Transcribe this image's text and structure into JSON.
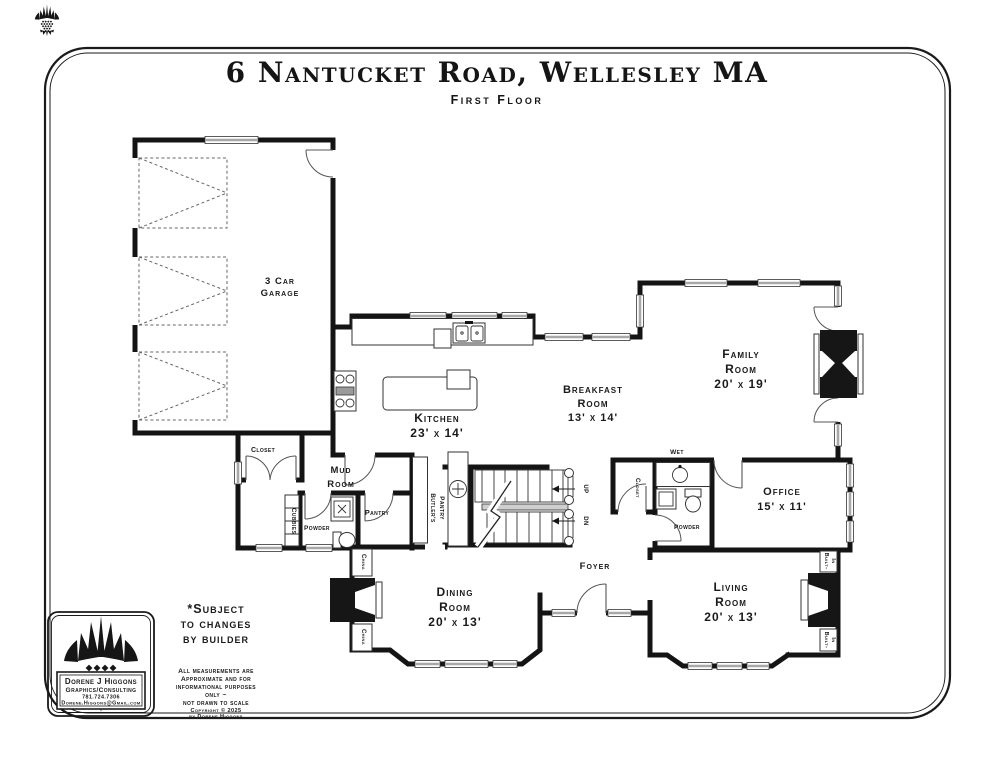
{
  "page": {
    "title": "6 Nantucket Road, Wellesley MA",
    "subtitle": "First Floor"
  },
  "rooms": {
    "garage": {
      "lines": [
        "3 Car",
        "Garage"
      ]
    },
    "closet_mud": {
      "label": "Closet"
    },
    "mud": {
      "lines": [
        "Mud",
        "Room"
      ]
    },
    "cubbies": {
      "label": "Cubbies"
    },
    "powder_mud": {
      "label": "Powder"
    },
    "pantry": {
      "label": "Pantry"
    },
    "butlers_pantry": {
      "lines": [
        "Butler's",
        "Pantry"
      ]
    },
    "kitchen": {
      "lines": [
        "Kitchen",
        "23' x 14'"
      ]
    },
    "breakfast": {
      "lines": [
        "Breakfast",
        "Room",
        "13' x 14'"
      ]
    },
    "family": {
      "lines": [
        "Family",
        "Room",
        "20' x 19'"
      ]
    },
    "wet_bar": {
      "lines": [
        "Wet",
        "Bar"
      ]
    },
    "closet_foyer": {
      "label": "Closet"
    },
    "powder_foyer": {
      "label": "Powder"
    },
    "office": {
      "lines": [
        "Office",
        "15' x 11'"
      ]
    },
    "foyer": {
      "label": "Foyer"
    },
    "dining": {
      "lines": [
        "Dining",
        "Room",
        "20' x 13'"
      ]
    },
    "china": {
      "label": "China"
    },
    "living": {
      "lines": [
        "Living",
        "Room",
        "20' x 13'"
      ]
    },
    "built_in": {
      "lines": [
        "Built-",
        "In"
      ]
    },
    "stairs": {
      "up": "UP",
      "down": "DN"
    }
  },
  "notes": {
    "subject": [
      "*Subject",
      "to changes",
      "by builder"
    ],
    "disclaimer": [
      "All measurements are",
      "Approximate and for",
      "informational purposes",
      "only ~",
      "not drawn to scale"
    ],
    "copyright": [
      "Copyright © 2025",
      "by Dorene Higgons"
    ]
  },
  "logo": {
    "name": "Dorene J Higgons",
    "tagline": "Graphics/Consulting",
    "phone": "781.724.7306",
    "email": "Dorene.Higgons@Gmail.com"
  },
  "colors": {
    "wall": "#141414",
    "window": "#a8a8a8",
    "paper": "#ffffff"
  }
}
